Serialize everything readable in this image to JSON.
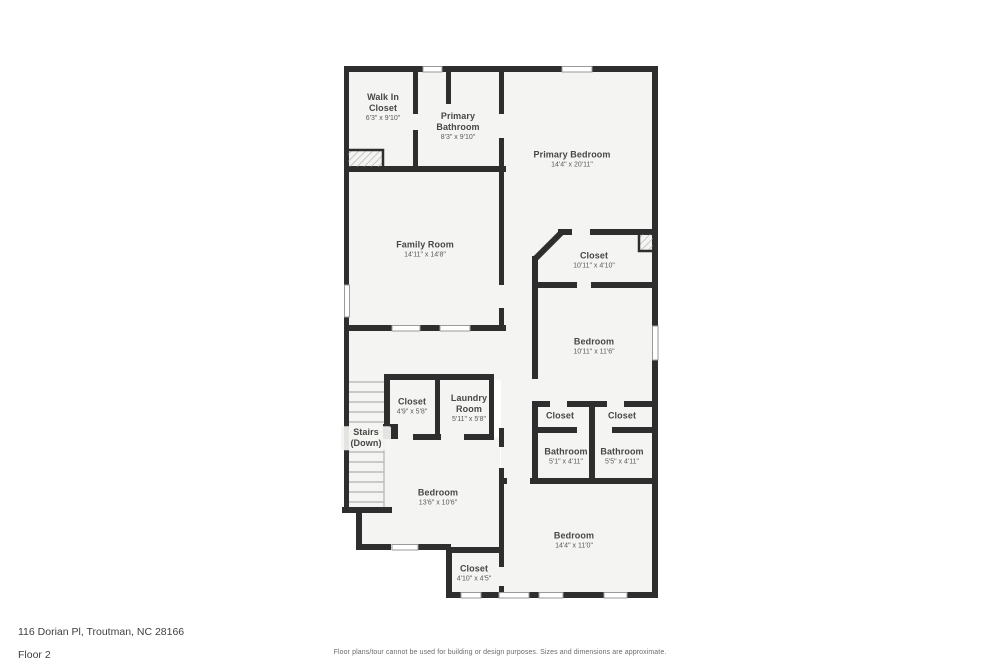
{
  "colors": {
    "wall": "#2e2e2e",
    "floor": "#f4f4f2",
    "window_frame": "#9a9a9a"
  },
  "rooms": [
    {
      "name": "Walk In Closet",
      "dims": "6'3\" x 9'10\""
    },
    {
      "name": "Primary Bathroom",
      "dims": "8'3\" x 9'10\""
    },
    {
      "name": "Primary Bedroom",
      "dims": "14'4\" x 20'11\""
    },
    {
      "name": "Family Room",
      "dims": "14'11\" x 14'8\""
    },
    {
      "name": "Closet",
      "dims": "10'11\" x 4'10\""
    },
    {
      "name": "Bedroom",
      "dims": "10'11\" x 11'6\""
    },
    {
      "name": "Closet",
      "dims": "4'9\" x 5'8\""
    },
    {
      "name": "Laundry Room",
      "dims": "5'11\" x 5'8\""
    },
    {
      "name": "Stairs (Down)",
      "dims": ""
    },
    {
      "name": "Closet",
      "dims": ""
    },
    {
      "name": "Closet",
      "dims": ""
    },
    {
      "name": "Bathroom",
      "dims": "5'1\" x 4'11\""
    },
    {
      "name": "Bathroom",
      "dims": "5'5\" x 4'11\""
    },
    {
      "name": "Bedroom",
      "dims": "13'6\" x 10'6\""
    },
    {
      "name": "Bedroom",
      "dims": "14'4\" x 11'0\""
    },
    {
      "name": "Closet",
      "dims": "4'10\" x 4'5\""
    }
  ],
  "footer": {
    "address": "116 Dorian Pl, Troutman, NC 28166",
    "floor": "Floor 2",
    "disclaimer": "Floor plans/tour cannot be used for building or design purposes. Sizes and dimensions are approximate."
  }
}
